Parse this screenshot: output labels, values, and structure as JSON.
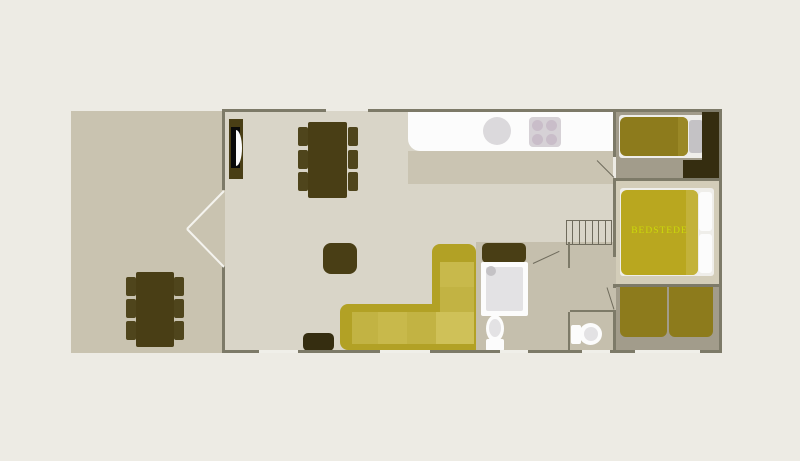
{
  "floorplan": {
    "type": "holiday-home-floor-plan",
    "labels": {
      "box_bed": "BEDSTEDE"
    },
    "colors": {
      "bg": "#edebe4",
      "wall": "#7d7a68",
      "window": "#f0efe9",
      "terrace": "#c9c3b0",
      "living": "#d9d5c8",
      "kitchen_band": "#cac4b2",
      "hall": "#c5bfad",
      "bedroom_dark_floor": "#a29c8b",
      "bedroom_light_floor": "#d3cdb9",
      "furniture": "#493e15",
      "chair": "#4f451c",
      "furniture_deep": "#352d10",
      "duvet_olive": "#8d7b1c",
      "duvet_olive_fold": "#9a8826",
      "duvet_mustard": "#b9a71f",
      "duvet_fold": "#c3b23a",
      "sofa_frame": "#b2a125",
      "sofa_seat": "#c8b94b",
      "sofa_seat_alt": "#c2b343",
      "sofa_seat_light": "#cfc158",
      "white": "#fcfcfc",
      "fixture_gray": "#e3e2e4",
      "pillow_gray": "#c4c2c5",
      "label": "#ccd90a",
      "door_line": "#6f6b5c",
      "terrace_door_line": "#f4f3ee",
      "sink": "#dbd9dc",
      "stove_plate": "#d6d1d6",
      "burner": "#c9bdc9",
      "stove_black": "#0a0a0a"
    }
  }
}
